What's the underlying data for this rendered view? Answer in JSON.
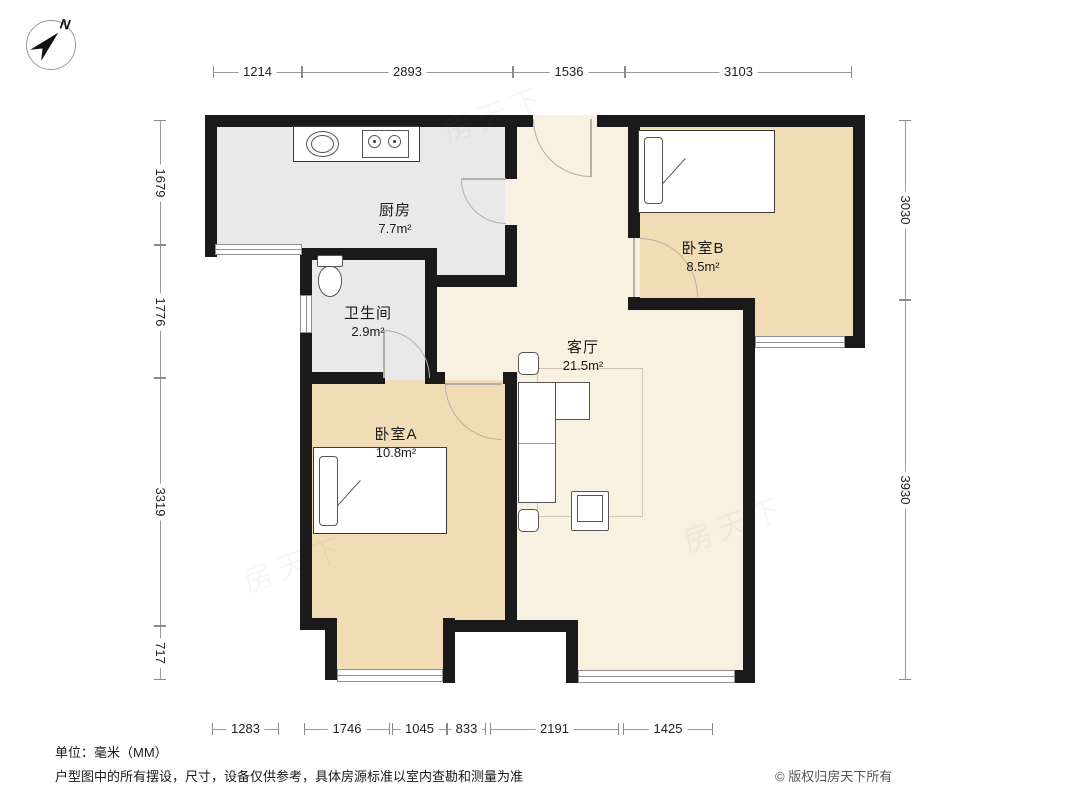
{
  "meta": {
    "unit_note": "单位：毫米（MM）",
    "disclaimer": "户型图中的所有摆设，尺寸，设备仅供参考，具体房源标准以室内查勘和测量为准",
    "copyright": "© 版权归房天下所有",
    "compass_label": "N",
    "watermark": "房天下"
  },
  "colors": {
    "wall": "#1a1a1a",
    "kitchen_floor": "#e9e9e9",
    "living_floor": "#f8f0e0",
    "bedroom_floor": "#f0ddb5"
  },
  "rooms": [
    {
      "id": "kitchen",
      "name": "厨房",
      "area": "7.7m²"
    },
    {
      "id": "bathroom",
      "name": "卫生间",
      "area": "2.9m²"
    },
    {
      "id": "living",
      "name": "客厅",
      "area": "21.5m²"
    },
    {
      "id": "bedroomA",
      "name": "卧室A",
      "area": "10.8m²"
    },
    {
      "id": "bedroomB",
      "name": "卧室B",
      "area": "8.5m²"
    }
  ],
  "dimensions": {
    "top": {
      "axis": "h",
      "line": 72,
      "segments": [
        {
          "label": "1214",
          "from": 213,
          "to": 302
        },
        {
          "label": "2893",
          "from": 302,
          "to": 513
        },
        {
          "label": "1536",
          "from": 513,
          "to": 625
        },
        {
          "label": "3103",
          "from": 625,
          "to": 852
        }
      ]
    },
    "bottom": {
      "axis": "h",
      "line": 729,
      "segments": [
        {
          "label": "1283",
          "from": 212,
          "to": 279
        },
        {
          "label": "1746",
          "from": 304,
          "to": 390
        },
        {
          "label": "1045",
          "from": 392,
          "to": 447
        },
        {
          "label": "833",
          "from": 447,
          "to": 486
        },
        {
          "label": "2191",
          "from": 490,
          "to": 619
        },
        {
          "label": "1425",
          "from": 623,
          "to": 713
        }
      ]
    },
    "left": {
      "axis": "v",
      "line": 160,
      "segments": [
        {
          "label": "1679",
          "from": 120,
          "to": 245
        },
        {
          "label": "1776",
          "from": 245,
          "to": 378
        },
        {
          "label": "3319",
          "from": 378,
          "to": 626
        },
        {
          "label": "717",
          "from": 626,
          "to": 680
        }
      ]
    },
    "right": {
      "axis": "v",
      "line": 905,
      "segments": [
        {
          "label": "3030",
          "from": 120,
          "to": 300
        },
        {
          "label": "3930",
          "from": 300,
          "to": 680
        }
      ]
    }
  }
}
